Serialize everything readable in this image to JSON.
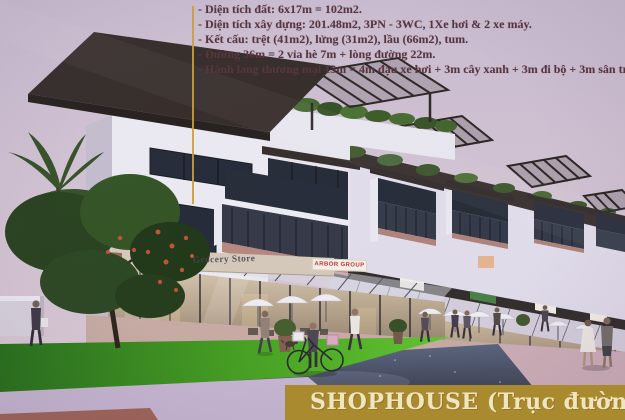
{
  "info_panel": {
    "lines": [
      "- Diện tích đất: 6x17m = 102m2.",
      "- Diện tích xây dựng: 201.48m2, 3PN - 3WC, 1Xe hơi & 2 xe máy.",
      "- Kết cấu: trệt (41m2), lửng (31m2), lầu (66m2), tum.",
      "- Đường 36m = 2 vỉa hè 7m + lòng đường 22m.",
      "- Hành lang thương mại 13m = 4m đậu xe hơi + 3m cây xanh + 3m đi bộ + 3m sân trư"
    ]
  },
  "banner": {
    "title": "SHOPHOUSE (Trục đường 36"
  },
  "storefront_signs": {
    "grocery": "Grocery Store",
    "arbor": "ARBOR GROUP"
  },
  "colors": {
    "banner_bg": "#aa8a2e",
    "banner_text": "#efe5c1",
    "info_text": "#4e2b35",
    "accent_line": "#c79b2f",
    "arbor_text": "#c23128",
    "sky": "#c9bcd1",
    "lawn_green": "#49b01e",
    "road": "#3a4457"
  }
}
